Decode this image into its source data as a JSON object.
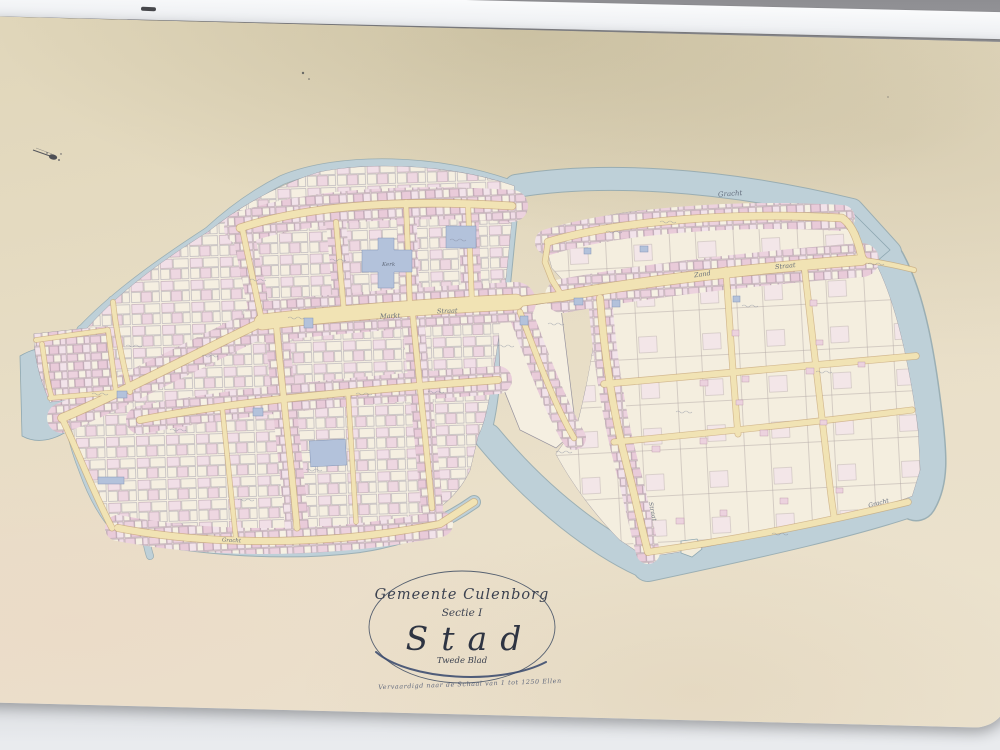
{
  "cartouche": {
    "municipality": "Gemeente Culenborg",
    "section": "Sectie I",
    "title": "Stad",
    "sheet_note": "Twede Blad",
    "scale_note": "Vervaardigd naar de Schaal van 1 tot 1250 Ellen"
  },
  "labels": {
    "water_north": "Gracht",
    "water_southeast": "Gracht",
    "water_south_west_town": "Gracht",
    "street_markt": "Markt",
    "street_markt_straat": "Straat",
    "street_zand": "Zand",
    "street_zand_straat": "Straat",
    "street_east_side": "Straat",
    "church": "Kerk"
  },
  "colors": {
    "table": "#96969a",
    "paper": "#e8dfc5",
    "town_paper": "#f5efe1",
    "water": "#bed0d8",
    "water_edge": "#8ea7b1",
    "street": "#f1e3b4",
    "street_edge": "#c9a876",
    "parcel_pink": "#ecd2de",
    "building_blue": "#b3c2db",
    "ink": "#5b6474"
  }
}
